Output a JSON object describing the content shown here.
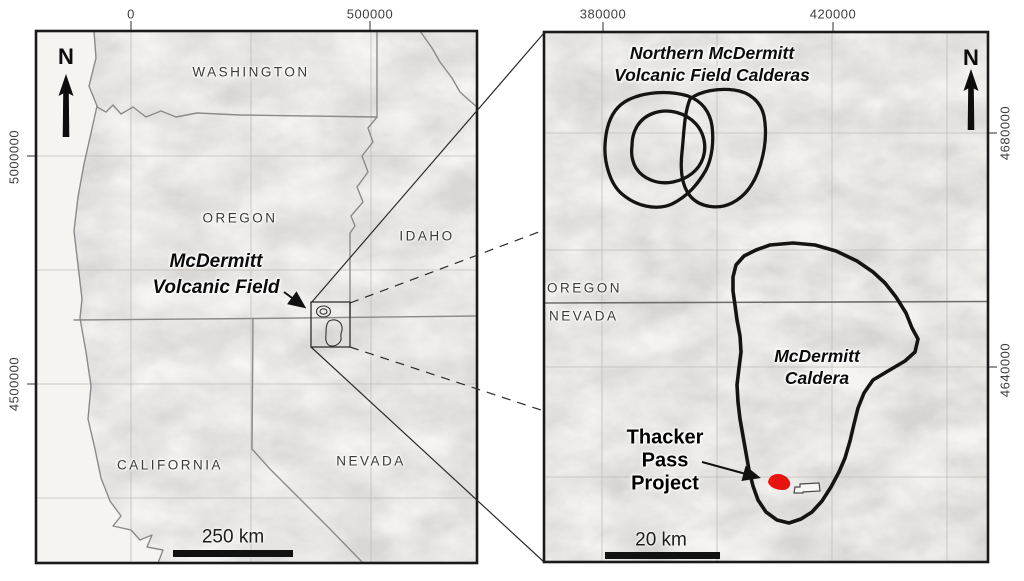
{
  "colors": {
    "thacker_red": "#e8120e",
    "caldera_outline": "#141414",
    "scale_bar": "#111111"
  },
  "left_panel": {
    "north_label": "N",
    "axis": {
      "top": [
        "0",
        "500000"
      ],
      "left": [
        "5000000",
        "4500000"
      ]
    },
    "states": {
      "washington": "WASHINGTON",
      "oregon": "OREGON",
      "idaho": "IDAHO",
      "california": "CALIFORNIA",
      "nevada": "NEVADA"
    },
    "annotation": {
      "mcdermitt_field_line1": "McDermitt",
      "mcdermitt_field_line2": "Volcanic Field"
    },
    "scale_label": "250 km"
  },
  "right_panel": {
    "north_label": "N",
    "axis": {
      "top": [
        "380000",
        "420000"
      ],
      "right": [
        "4680000",
        "4640000"
      ]
    },
    "states": {
      "oregon": "OREGON",
      "nevada": "NEVADA"
    },
    "annotations": {
      "northern_calderas_line1": "Northern McDermitt",
      "northern_calderas_line2": "Volcanic Field Calderas",
      "mcdermitt_caldera_line1": "McDermitt",
      "mcdermitt_caldera_line2": "Caldera",
      "thacker_pass_line1": "Thacker",
      "thacker_pass_line2": "Pass",
      "thacker_pass_line3": "Project"
    },
    "scale_label": "20 km"
  }
}
